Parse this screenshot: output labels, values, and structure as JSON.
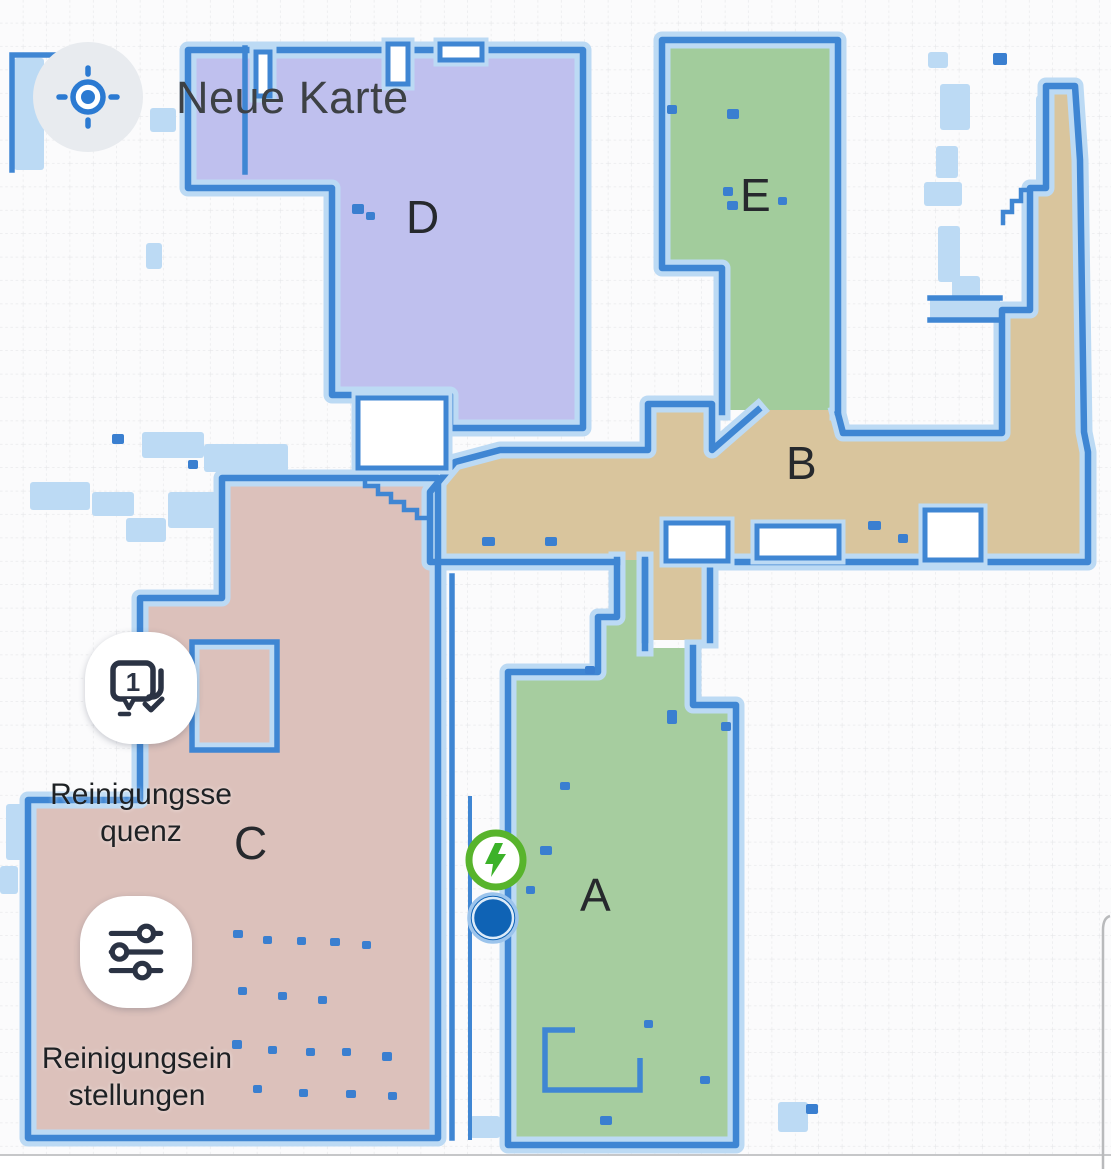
{
  "header": {
    "map_name": "Neue Karte"
  },
  "map": {
    "rooms": [
      {
        "id": "A",
        "label": "A",
        "color": "#a6cd9f"
      },
      {
        "id": "B",
        "label": "B",
        "color": "#d9c59d"
      },
      {
        "id": "C",
        "label": "C",
        "color": "#dcc1bb"
      },
      {
        "id": "D",
        "label": "D",
        "color": "#bfc0ee"
      },
      {
        "id": "E",
        "label": "E",
        "color": "#a2cc9c"
      }
    ],
    "wall_color": "#3f86d3",
    "buffer_color": "#bcdaf4",
    "grid_color": "#e6e7e9",
    "markers": {
      "dock": {
        "icon": "charging-dock-icon",
        "color": "#58b42c"
      },
      "robot": {
        "icon": "robot-position-icon",
        "color": "#0f63b5"
      }
    }
  },
  "controls": {
    "locate_button": {
      "icon": "locate-target-icon",
      "accent": "#2b7ad2"
    },
    "sequence_button": {
      "icon": "cleaning-sequence-icon",
      "label": "Reinigungsse\nquenz"
    },
    "settings_button": {
      "icon": "sliders-icon",
      "label": "Reinigungsein\nstellungen"
    }
  }
}
